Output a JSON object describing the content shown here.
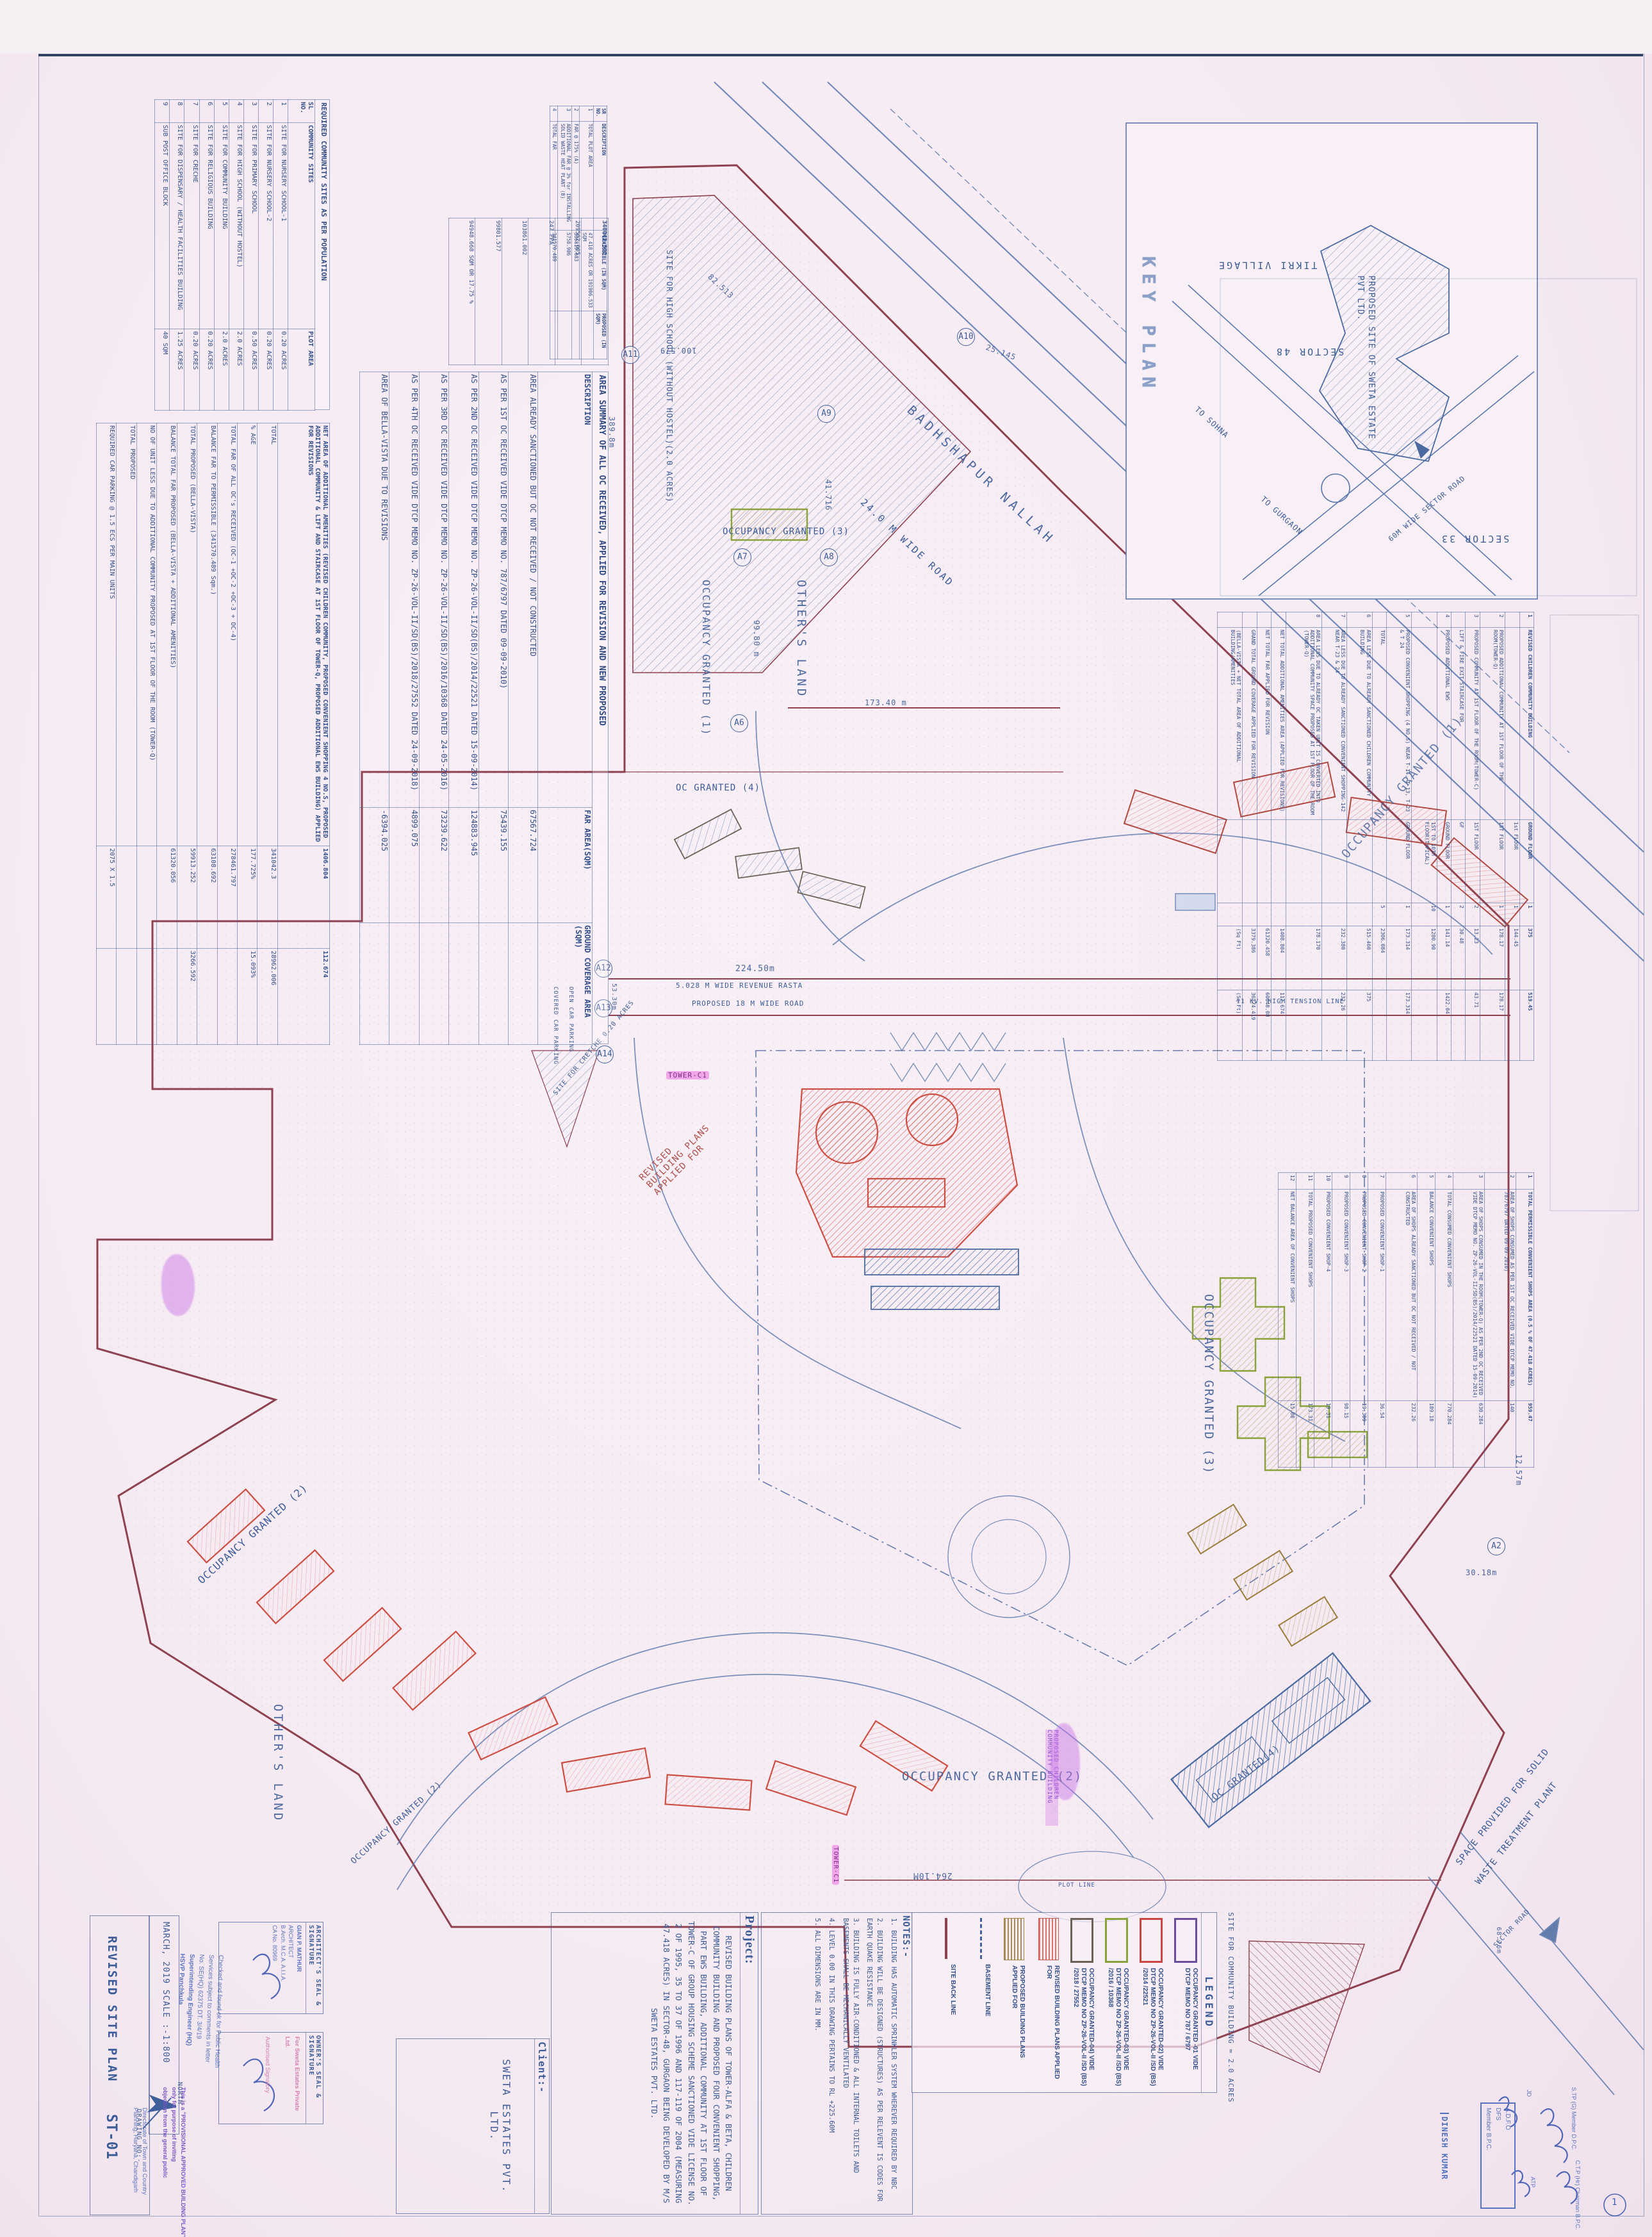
{
  "sheet": {
    "title_block": {
      "drawing_title": "REVISED SITE PLAN",
      "drawing_code": "ST-01",
      "date_scale": "MARCH, 2019   SCALE :-1:800",
      "drawing_no_label": "DRAWING NO:-",
      "north_label": "NORTH",
      "architect_seal_label": "ARCHITECT'S SEAL & SIGNATURE",
      "owner_seal_label": "OWNER'S SEAL & SIGNATURE",
      "architect_stamp": [
        "GIAN P. MATHUR",
        "ARCHITECT",
        "B.Arch. M.C.A. A.I.I.A.",
        "CA No. 80969"
      ],
      "owner_stamp": [
        "For Sweta Estates Private Ltd.",
        "Authorised Signatory"
      ],
      "client_label": "Client:-",
      "client_name": "SWETA ESTATES PVT. LTD.",
      "project_label": "Project:",
      "project_text": "REVISED BUILDING PLANS OF TOWER-ALFA & BETA, CHILDREN COMMUNITY BUILDING AND PROPOSED FOUR CONVENIENT SHOPPING, PART EWS BUILDING, ADDITIONAL COMMUNITY AT 1ST FLOOR OF TOWER-C OF GROUP HOUSING SCHEME SANCTIONED VIDE LICENSE NO. 2 OF 1995, 35 TO 37 OF 1996 AND 117-119 OF 2004 (MEASURING 47.418 ACRES) IN SECTOR-48, GURGAON BEING DEVELOPED BY M/S SWETA ESTATES PVT. LTD."
    },
    "notes": {
      "label": "NOTES:-",
      "items": [
        "1. BUILDING HAS AUTOMATIC SPRINKLER SYSTEM WHEREVER REQUIRED BY NBC",
        "2. BUILDING WILL BE DESIGNED (STRUCTURES) AS PER RELEVENT IS CODES FOR EARTH QUAKE RESISTANCE",
        "3. BUILDING IS FULLY AIR-CONDITIONED & ALL INTERNAL TOILETS AND BASEMENTS SHALL BE MECHANICALLY VENTILATED",
        "4. LEVEL 0.00 IN THIS DRAWING PERTAINS TO RL +225.60M",
        "5. ALL DIMENSIONS ARE IN MM."
      ]
    }
  },
  "legend": {
    "title": "LEGEND",
    "entries": [
      {
        "label": "OCCUPANCY GRANTED -01 VIDE DTCP MEMO NO 787 / 6797"
      },
      {
        "label": "OCCUPANCY GRANTED-02) VIDE DTCP MEMO NO ZP-26-VOL-II /SD (BS) /2014 /22521"
      },
      {
        "label": "OCCUPANCY GRANTED-03) VIDE DTCP MEMO NO ZP-26-VOL-II /SD (BS) /2016 / 10368"
      },
      {
        "label": "OCCUPANCY GRANTED-04) VIDE DTCP MEMO NO ZP-26-VOL-II /SD (BS) /2018 / 27552"
      },
      {
        "label": "REVISED BUILDING PLANS APPLIED FOR"
      },
      {
        "label": "PROPOSED BUILDING PLANS APPLIED FOR"
      },
      {
        "label": "BASEMENT LINE"
      },
      {
        "label": "SITE BACK LINE"
      }
    ],
    "community_note": "SITE FOR COMMUNITY BUILDING = 2.0 ACRES"
  },
  "key_plan": {
    "title": "KEY PLAN",
    "tikri": "TIKRI VILLAGE",
    "sector48": "SECTOR 48",
    "sector33": "SECTOR 33",
    "to_sohna": "TO SOHNA",
    "to_gurgaon": "TO GURGAON",
    "sector_road60": "60M WIDE SECTOR ROAD",
    "site": "PROPOSED SITE OF SWETA ESTATE PVT LTD."
  },
  "stamps": {
    "health": [
      "Checked and found ok for Public Health",
      "Services subject to comments in letter",
      "No. SE(HQ) 62375  DT. 3/4/19",
      "Superintending Engineer (HQ)",
      "HSVP Panchkula"
    ],
    "dtcp": [
      "Directorate of Town and Country",
      "Planning, Haryana, Chandigarh"
    ],
    "provisional": [
      "This is a \"PROVISIONAL APPROVED BUILDING PLAN\"",
      "only for purpose of inviting",
      "objection from the general public"
    ],
    "dinesh": "DINESH KUMAR",
    "adfo": [
      "A.D.F.O",
      "DFS",
      "Member B.P.C."
    ],
    "stp": "S.TP (G) Member D.P.C.",
    "ctp": "C.T.P (Hr) Chairman B.P.C.",
    "atp": "ATP",
    "jd": "JD",
    "circled_mark": "1"
  },
  "tables": {
    "community_sites": {
      "title": "REQUIRED COMMUNITY SITES AS PER POPULATION",
      "rows": [
        [
          "SL NO.",
          "COMMUNITY SITES",
          "PLOT AREA"
        ],
        [
          "1",
          "SITE FOR NURSERY SCHOOL-1",
          "0.20 ACRES"
        ],
        [
          "2",
          "SITE FOR NURSERY SCHOOL-2",
          "0.20 ACRES"
        ],
        [
          "3",
          "SITE FOR PRIMARY SCHOOL",
          "0.50 ACRES"
        ],
        [
          "4",
          "SITE FOR HIGH SCHOOL (WITHOUT HOSTEL)",
          "2.0 ACRES"
        ],
        [
          "5",
          "SITE FOR COMMUNITY BUILDING",
          "2.0 ACRES"
        ],
        [
          "6",
          "SITE FOR RELIGIOUS BUILDING",
          "0.20 ACRES"
        ],
        [
          "7",
          "SITE FOR CRECHE",
          "0.20 ACRES"
        ],
        [
          "8",
          "SITE FOR DISPENSARY / HEALTH FACILITIES BUILDING",
          "1.25 ACRES"
        ],
        [
          "9",
          "SUB POST OFFICE BLOCK",
          "40 SQM"
        ]
      ]
    },
    "plot_summary": {
      "rows": [
        [
          "SR NO.",
          "DESCRIPTION",
          "PERMISSIBLE (IN SQM)",
          "PROPOSED (IN SQM)"
        ],
        [
          "1",
          "TOTAL PLOT AREA",
          "47.418 ACRES OR 191906.533 SQM",
          ""
        ],
        [
          "2",
          "FAR @ 175% (A)",
          "335819.683",
          ""
        ],
        [
          "3",
          "ADDITIONAL FAR @ 3% for INSTALLING SOLID WASTE HEAT PLANT (B)",
          "5758.906",
          ""
        ],
        [
          "4",
          "TOTAL FAR",
          "341570.489",
          ""
        ]
      ]
    },
    "area_summary": {
      "title": "AREA SUMMARY OF ALL OC RECEIVED, APPLIED FOR REVISION AND NEW PROPOSED",
      "rows": [
        [
          "DESCRIPTION",
          "FAR AREA(SQM)",
          "GROUND COVERAGE AREA (SQM)"
        ],
        [
          "AREA ALREADY SANCTIONED BUT OC NOT RECEIVED / NOT CONSTRUCTED",
          "67567.724",
          ""
        ],
        [
          "AS PER 1ST OC RECEIVED VIDE DTCP MEMO NO. 787/6797 DATED 09-09-2010)",
          "75439.155",
          ""
        ],
        [
          "AS PER 2ND OC RECEIVED VIDE DTCP MEMO NO. ZP-26-VOL-II/SD(BS)/2014/22521 DATED 15-09-2014)",
          "124883.945",
          ""
        ],
        [
          "AS PER 3RD OC RECEIVED VIDE DTCP MEMO NO. ZP-26-VOL-II/SD(BS)/2016/10368 DATED 24-05-2016)",
          "73239.622",
          ""
        ],
        [
          "AS PER 4TH OC RECEIVED VIDE DTCP MEMO NO. ZP-26-VOL-II/SD(BS)/2018/27552 DATED 24-09-2018)",
          "4899.075",
          ""
        ],
        [
          "AREA OF BELLA-VISTA DUE TO REVISIONS",
          "-6394.025",
          ""
        ]
      ],
      "stats": [
        [
          "340042.300"
        ],
        [
          "209502.005"
        ],
        [
          "247 PPA"
        ],
        [
          "103861.002"
        ],
        [
          "99801.577"
        ],
        [
          "94948.668 SQM OR 17.75 %"
        ]
      ]
    },
    "left_summary": {
      "rows": [
        [
          "NET AREA OF ADDITIONAL AMENITIES (REVISED CHILDREN COMMUNITY, PROPOSED CONVENIENT SHOPPING 4 NO.S, PROPOSED ADDITIONAL COMMUNITY & LIFT AND STAIRCASE AT 1ST FLOOR OF TOWER-Q, PROPOSED ADDITIONAL EWS BUILDING) APPLIED FOR REVISIONS",
          "1406.804",
          "112.674"
        ],
        [
          "TOTAL",
          "341042.3",
          "28962.006"
        ],
        [
          "% AGE",
          "177.725%",
          "15.093%"
        ],
        [
          "TOTAL FAR OF ALL OC's RECEIVED (OC-1 +OC-2 +OC-3 + OC-4)",
          "278461.797",
          ""
        ],
        [
          "BALANCE FAR TO PERMISSIBLE (341570.489 Sqm.)",
          "63108.692",
          ""
        ],
        [
          "TOTAL PROPOSED (BELLA-VISTA)",
          "59913.252",
          "3266.592"
        ],
        [
          "BALANCE TOTAL FAR PROPOSED (BELLA-VISTA + ADDITIONAL AMENITIES)",
          "61320.056",
          ""
        ],
        [
          "NO OF UNIT LESS DUE TO ADDITIONAL COMMUNITY PROPOSED AT 1ST FLOOR OF THE ROOM (TOWER-Q)",
          "",
          ""
        ],
        [
          "TOTAL PROPOSED",
          "",
          ""
        ],
        [
          "REQUIRED CAR PARKING @ 1.5 ECS PER MAIN UNITS",
          "2075 X 1.5",
          ""
        ]
      ]
    },
    "amenities": {
      "rows": [
        [
          "1",
          "REVISED CHILDREN COMMUNITY BUILDING",
          "GROUND FLOOR",
          "1",
          "375",
          "519.45"
        ],
        [
          "",
          "",
          "1st FLOOR",
          "1",
          "144.45",
          ""
        ],
        [
          "2",
          "PROPOSED ADDITIONAL COMMUNITY AT 1ST FLOOR OF THE ROOM(TOWER-Q)",
          "1ST FLOOR",
          "1",
          "178.17",
          "178.17"
        ],
        [
          "3",
          "PROPOSED COMMUNITY AT 1ST FLOOR OF THE ROOM(TOWER-C)",
          "1ST FLOOR",
          "2",
          "13.23",
          "43.71"
        ],
        [
          "",
          "LIFT & FIRE EXIT STAIRCASE FOR",
          "GF",
          "2",
          "30.48",
          ""
        ],
        [
          "4",
          "PROPOSED ADDITIONAL EWS",
          "GROUND FLOOR",
          "1",
          "141.14",
          "1422.04"
        ],
        [
          "",
          "",
          "1ST TO 10TH FLOOR(TYPICAL)",
          "10",
          "1280.90",
          ""
        ],
        [
          "5",
          "PROPOSED CONVENIENT SHOPPING (4 NO.S) NEAR T-14, T-13, T-23 & T 24",
          "GROUND FLOOR",
          "1",
          "173.314",
          "173.314"
        ],
        [
          "",
          "TOTAL",
          "",
          "5",
          "2306.084",
          ""
        ],
        [
          "6",
          "AREA LESS DUE TO ALREADY SANCTIONED CHILDREN COMMUNITY BUILDING",
          "",
          "",
          "515.460",
          "375"
        ],
        [
          "7",
          "AREA LESS DUE TO ALREADY SANCTIONED CONVENIENT SHOPPING-142 NEAR T-23 & 24",
          "",
          "",
          "232.380",
          "232.26"
        ],
        [
          "8",
          "AREA LESS DUE TO ALREADY OC TAKEN UNIT IS CONVERTED INTO ADDITIONAL COMMUNITY SPACE PROPOSED AT 1ST FLOOR OF THE ROOM (TOWER-Q)",
          "",
          "",
          "178.170",
          ""
        ],
        [
          "",
          "NET TOTAL ADDITIONAL AMENITIES AREA (APPLIED FOR REVISIONS)",
          "",
          "",
          "1408.804",
          "112.674"
        ],
        [
          "",
          "NET TOTAL FAR APPLIED FOR REVISION",
          "",
          "",
          "61320.458",
          "60048.08"
        ],
        [
          "",
          "GRAND TOTAL GROUND COVERAGE APPLIED FOR REVISION",
          "",
          "",
          "3379.386",
          "36374.419"
        ],
        [
          "",
          "(BELLA-VISTA + NET TOTAL AREA OF ADDITIONAL BUILDING/AMENITIES",
          "",
          "",
          "(Sq Ft)",
          "(Sq Ft)"
        ]
      ]
    },
    "shops": {
      "rows": [
        [
          "1",
          "TOTAL PERMISSIBLE CONVENIENT SHOPS AREA (0.5 % OF 47.418 ACRES)",
          "959.47"
        ],
        [
          "2",
          "AREA OF SHOPS CONSUMED AS PER 1ST OC RECEIVED VIDE DTCP MEMO NO. 787/6797 DATED 09-09-2010)",
          "140"
        ],
        [
          "3",
          "AREA OF SHOPS CONSUMED IN THE ROOM(TOWER-Q) AS PER 2ND OC RECEIVED VIDE DTCP MEMO NO. ZP-26-VOL-II/SD(BS)/2014/22521 DATED 15-09-2014)",
          "630.284"
        ],
        [
          "4",
          "TOTAL CONSUMED CONVENIENT SHOPS",
          "770.284"
        ],
        [
          "5",
          "BALANCE CONVENIENT SHOPS",
          "189.18"
        ],
        [
          "6",
          "AREA OF SHOPS ALREADY SANCTIONED BUT OC NOT RECEIVED / NOT CONSTRUCTED",
          "232.26"
        ],
        [
          "7",
          "PROPOSED CONVENIENT SHOP-1",
          "36.54"
        ],
        [
          "8",
          "PROPOSED CONVENIENT SHOP-2",
          "19.309"
        ],
        [
          "9",
          "PROPOSED CONVENIENT SHOP-3",
          "98.15"
        ],
        [
          "10",
          "PROPOSED CONVENIENT SHOP-4",
          "19.31"
        ],
        [
          "11",
          "TOTAL PROPOSED CONVENIENT SHOPS",
          "173.31"
        ],
        [
          "12",
          "NET BALANCE AREA OF CONVENIENT SHOPS",
          "15.88"
        ]
      ]
    }
  },
  "plan": {
    "labels": {
      "occ1": "OCCUPANCY GRANTED (1)",
      "occ2": "OCCUPANCY GRANTED (2)",
      "occ3": "OCCUPANCY GRANTED (3)",
      "oc4_top": "OC GRANTED (4)",
      "oc4_bottom": "OC GRANTED(4)",
      "revised": "REVISED BUILDING PLANS APPLIED FOR",
      "others_land": "OTHER'S LAND",
      "badhshapur": "BADHSHAPUR NALLAH",
      "road24": "24.0 M WIDE ROAD",
      "rasta": "5.028 M WIDE REVENUE RASTA",
      "road18": "PROPOSED 18 M WIDE ROAD",
      "ht_line": "11 KV. HIGH TENSION LINE",
      "school": "SITE FOR HIGH SCHOOL (WITHOUT HOSTEL)(2.0 ACRES)",
      "creche": "SITE FOR CRETCHE 0.20 ACRES",
      "covered_parking": "COVERED CAR PARKING",
      "open_parking": "OPEN CAR PARKING",
      "waste1": "SPACE PROVIDED FOR SOLID",
      "waste2": "WASTE TREATMENT PLANT",
      "tower_c1": "TOWER-C1",
      "children": "PROPOSED CHILDREN COMMUNITY BUILDING",
      "plot_line": "PLOT LINE",
      "sector_road": "SECTOR ROAD"
    },
    "dims": {
      "d224": "224.50m",
      "d264": "264.10M",
      "d173": "173.40 m",
      "d99": "99.80 m",
      "d389": "389.8m",
      "d53": "53.30m",
      "d68": "68.76m",
      "d30": "30.18m",
      "d12": "12.57m",
      "d41": "41.716",
      "d100": "100.579",
      "d25": "25.145",
      "d82": "82.513"
    },
    "markers": [
      "A2",
      "A6",
      "A7",
      "A8",
      "A9",
      "A10",
      "A11",
      "A12",
      "A13",
      "A14"
    ]
  }
}
